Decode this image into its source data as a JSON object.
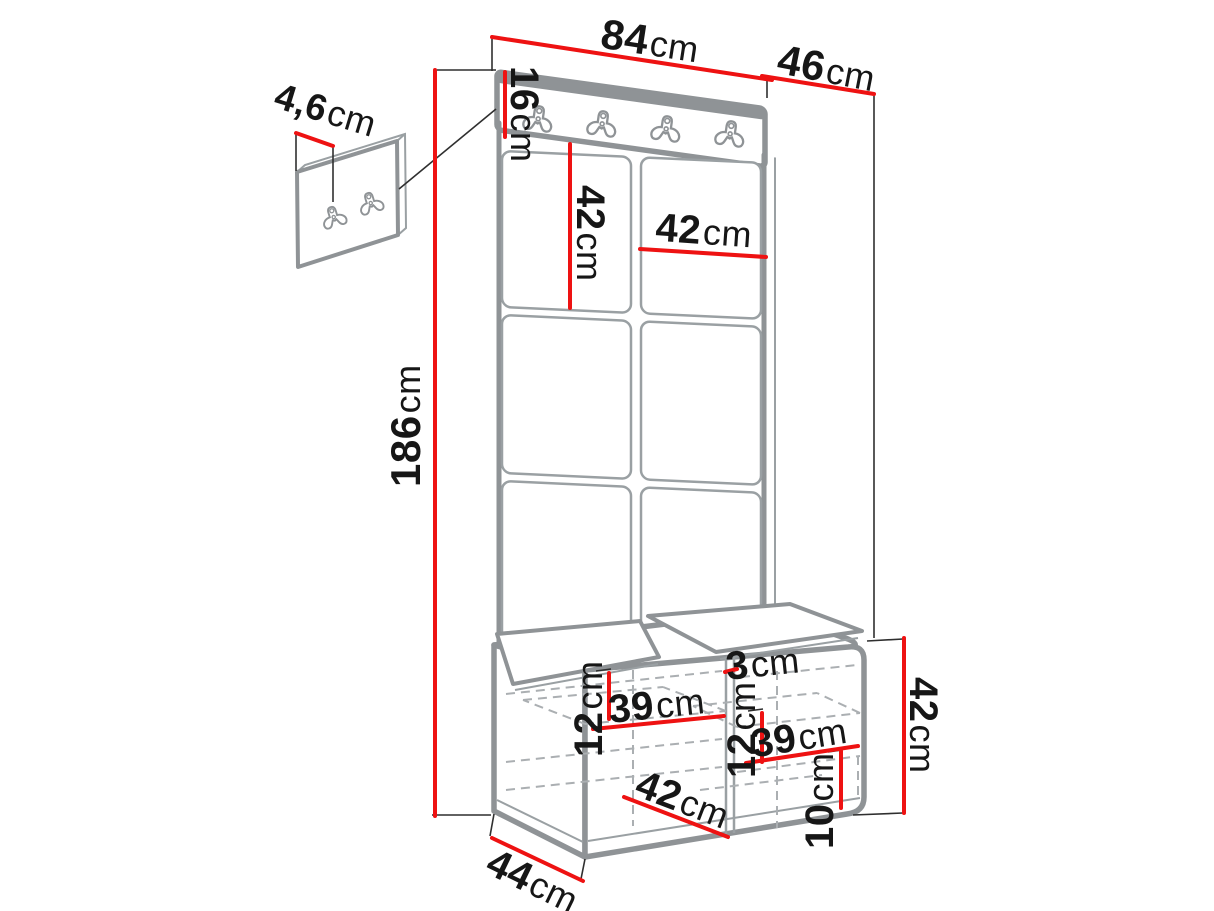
{
  "diagram": {
    "type": "furniture-dimension-drawing",
    "subject": "hallway wardrobe set: upholstered panel wall with hook rail, shoe bench and separate small hook panel",
    "colors": {
      "dimension_red": "#ee1212",
      "outline_gray": "#8f9396",
      "hidden_dash_gray": "#abafb2",
      "text_black": "#161616",
      "background": "#ffffff"
    },
    "hooks": {
      "main_rail_count": 4,
      "small_panel_count": 2
    },
    "labels": {
      "width_top": {
        "num": "84",
        "unit": "cm"
      },
      "depth_top": {
        "num": "46",
        "unit": "cm"
      },
      "rail_height": {
        "num": "16",
        "unit": "cm"
      },
      "total_height": {
        "num": "186",
        "unit": "cm"
      },
      "panel_height": {
        "num": "42",
        "unit": "cm"
      },
      "panel_width": {
        "num": "42",
        "unit": "cm"
      },
      "small_panel_thickness": {
        "num": "4,6",
        "unit": "cm"
      },
      "bench_depth": {
        "num": "44",
        "unit": "cm"
      },
      "bench_opening_width": {
        "num": "42",
        "unit": "cm"
      },
      "shelf_width_left": {
        "num": "39",
        "unit": "cm"
      },
      "shelf_drop_left": {
        "num": "12",
        "unit": "cm"
      },
      "divider_thickness": {
        "num": "3",
        "unit": "cm"
      },
      "shelf_drop_right": {
        "num": "12",
        "unit": "cm"
      },
      "shelf_width_right": {
        "num": "39",
        "unit": "cm"
      },
      "bottom_clearance": {
        "num": "10",
        "unit": "cm"
      },
      "bench_height": {
        "num": "42",
        "unit": "cm"
      }
    }
  }
}
